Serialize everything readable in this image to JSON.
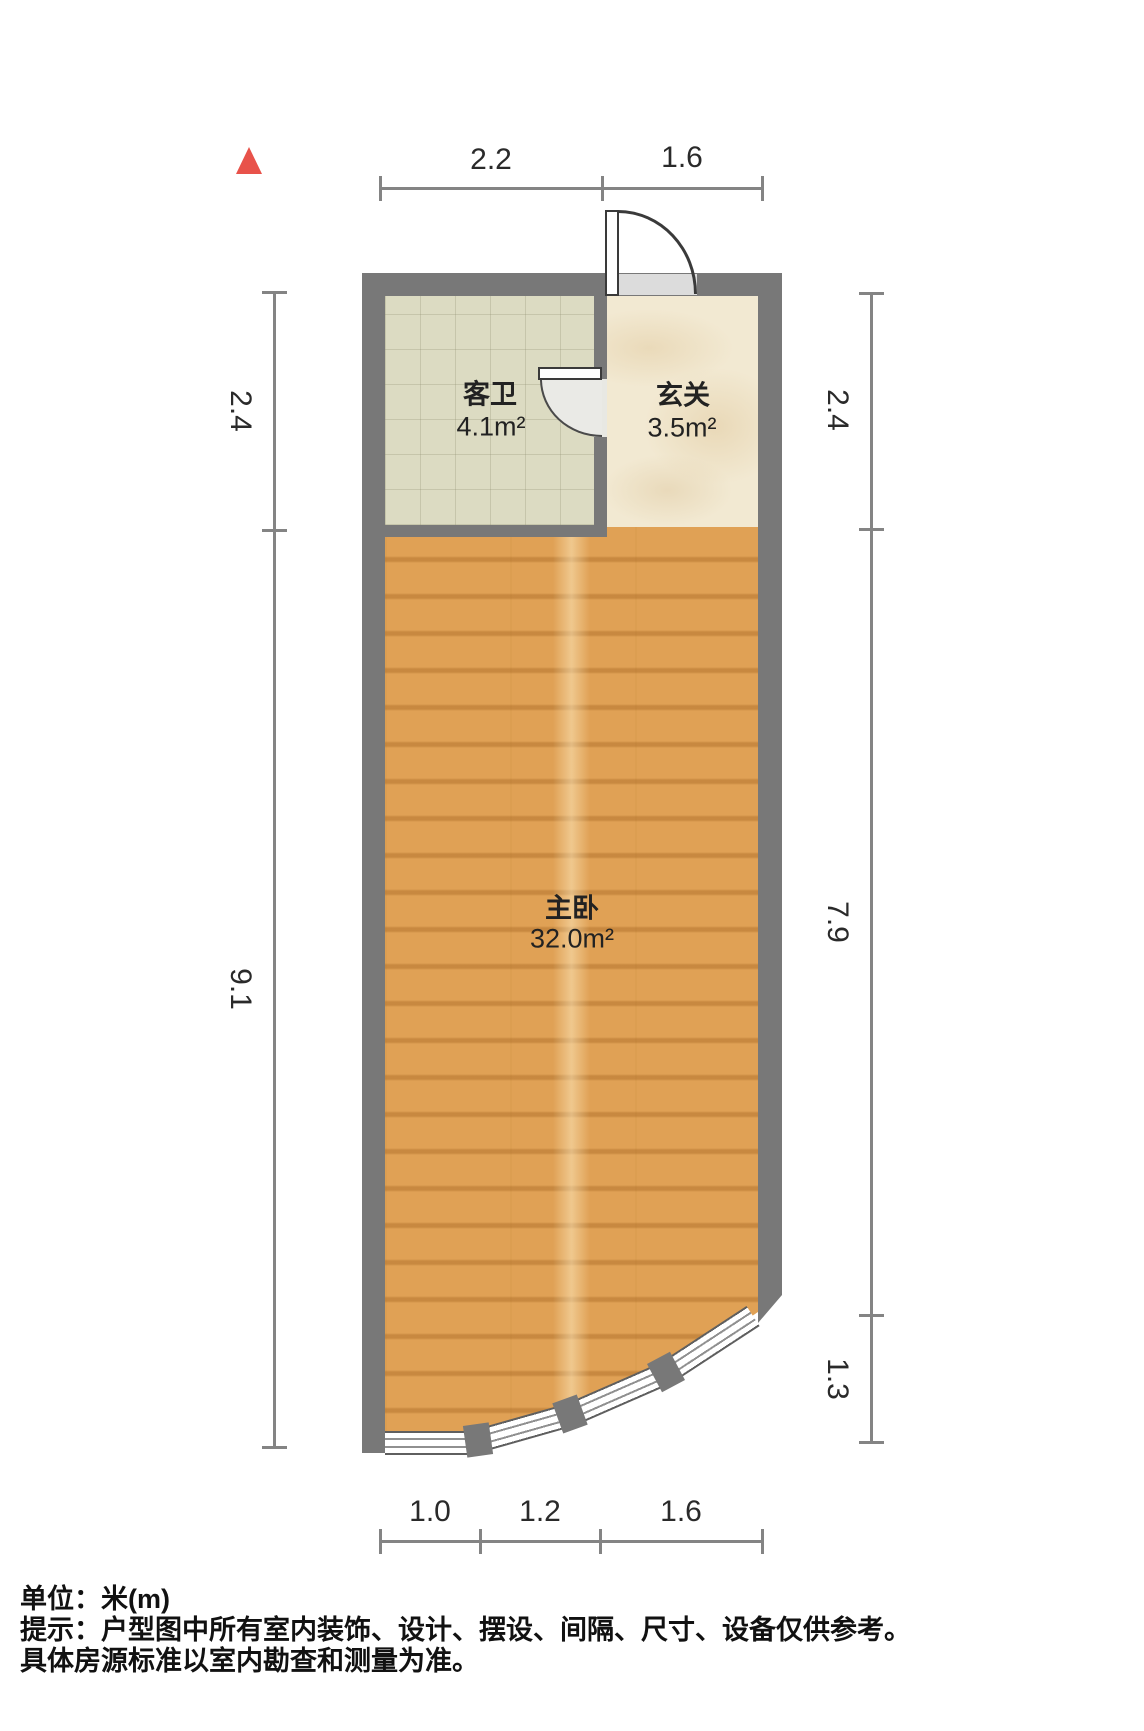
{
  "rooms": {
    "bathroom": {
      "name": "客卫",
      "area": "4.1m²"
    },
    "hallway": {
      "name": "玄关",
      "area": "3.5m²"
    },
    "bedroom": {
      "name": "主卧",
      "area": "32.0m²"
    }
  },
  "dimensions": {
    "top": [
      "2.2",
      "1.6"
    ],
    "bottom": [
      "1.0",
      "1.2",
      "1.6"
    ],
    "left": [
      "2.4",
      "9.1"
    ],
    "right": [
      "2.4",
      "7.9",
      "1.3"
    ]
  },
  "footer": {
    "line1": "单位：米(m)",
    "line2": "提示：户型图中所有室内装饰、设计、摆设、间隔、尺寸、设备仅供参考。",
    "line3": "具体房源标准以室内勘查和测量为准。"
  },
  "colors": {
    "wall": "#787878",
    "dimension_line": "#848484",
    "wood_floor": "#e0a155",
    "tile_floor": "#dcdbc2",
    "marble_floor": "#f2e9d2",
    "north_arrow": "#e8524a",
    "door_fill": "#eaeae6",
    "text": "#222222"
  }
}
